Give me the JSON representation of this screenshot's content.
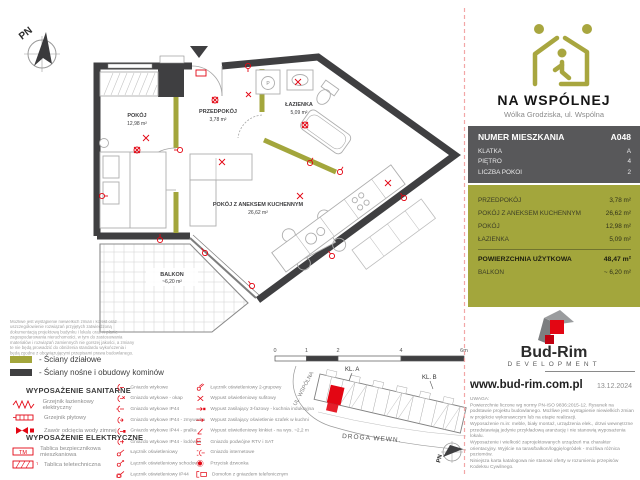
{
  "compass": {
    "label": "PN"
  },
  "floor_plan": {
    "rooms": [
      {
        "name": "POKÓJ",
        "area": "12,98 m²"
      },
      {
        "name": "PRZEDPOKÓJ",
        "area": "3,78 m²"
      },
      {
        "name": "ŁAZIENKA",
        "area": "5,09 m²"
      },
      {
        "name": "POKÓJ Z ANEKSEM KUCHENNYM",
        "area": "26,62 m²"
      },
      {
        "name": "BALKON",
        "area": "~6,20 m²"
      }
    ],
    "washer_label": "P"
  },
  "disclaimer_small": "Możliwe jest wystąpienie niewielkich zmian i korekt oraz uszczegółowienie rozwiązań przyjętych zatwierdzoną dokumentacją projektową budynku i lokalu oraz w planie zagospodarowania nieruchomości, w tym do zastosowania materiałów i rozwiązań zamiennych nie gorszej jakości, a zmiany te nie będą prowadzić do obniżenia standardu wykończenia i będą zgodne z obowiązującymi przepisami prawa budowlanego.",
  "wall_legend": [
    {
      "label": "- Ściany działowe",
      "color": "#a3a63c"
    },
    {
      "label": "- Ściany nośne i obudowy kominów",
      "color": "#3f3f41"
    }
  ],
  "sanitary": {
    "title": "WYPOSAŻENIE SANITARNE",
    "items": [
      "Grzejnik łazienkowy elektryczny",
      "Grzejnik płytowy",
      "Zawór odcięcia wody zimnej"
    ]
  },
  "electrical": {
    "title": "WYPOSAŻENIE ELEKTRYCZNE",
    "items": [
      {
        "tag": "TM",
        "label": "Tablica bezpiecznikowa mieszkaniowa"
      },
      {
        "tag": "TT",
        "label": "Tablica teletechniczna"
      }
    ]
  },
  "symbol_legend": {
    "col1": [
      "Gniazdo wtykowe",
      "Gniazdo wtykowe - okap",
      "Gniazdo wtykowe IP44",
      "Gniazdo wtykowe IP44 - zmywarka",
      "Gniazdo wtykowe IP44 - pralka",
      "Gniazdo wtykowe IP44 - lodówka",
      "Łącznik oświetleniowy",
      "Łącznik oświetleniowy schodowy",
      "Łącznik oświetleniowy IP44"
    ],
    "col2": [
      "Łącznik oświetleniowy 2-grupowy",
      "Wypust oświetleniowy sufitowy",
      "Wypust zasilający 3-fazowy - kuchnia indukcyjna",
      "Wypust zasilający oświetlenie szafek w kuchni",
      "Wypust oświetleniowy kinkiet - na wys. ~2,2 m",
      "Gniazdo podwójne RTV i SAT",
      "Gniazdo internetowe",
      "Przycisk dzwonka",
      "Domofon z gniazdem telefonicznym"
    ]
  },
  "scale_bar": {
    "ticks": [
      "0",
      "1",
      "2",
      "4",
      "6m"
    ]
  },
  "site_plan": {
    "stair_a": "KL. A",
    "stair_b": "KL. B",
    "road": "DROGA WEWN.",
    "street": "UL. WSPÓLNA",
    "north": "PN"
  },
  "branding": {
    "estate": "NA WSPÓLNEJ",
    "location": "Wólka Grodziska, ul. Wspólna",
    "developer": "Bud-Rim",
    "developer_sub": "DEVELOPMENT",
    "website": "www.bud-rim.com.pl",
    "date": "13.12.2024"
  },
  "summary": {
    "header_label": "NUMER  MIESZKANIA",
    "header_value": "A048",
    "rows": [
      {
        "label": "KLATKA",
        "value": "A"
      },
      {
        "label": "PIĘTRO",
        "value": "4"
      },
      {
        "label": "LICZBA POKOI",
        "value": "2"
      }
    ],
    "areas": [
      {
        "label": "PRZEDPOKÓJ",
        "value": "3,78 m²"
      },
      {
        "label": "POKÓJ Z ANEKSEM KUCHENNYM",
        "value": "26,62 m²"
      },
      {
        "label": "POKÓJ",
        "value": "12,98 m²"
      },
      {
        "label": "ŁAZIENKA",
        "value": "5,09 m²"
      }
    ],
    "total": {
      "label": "POWIERZCHNIA UŻYTKOWA",
      "value": "48,47 m²"
    },
    "balcony": {
      "label": "BALKON",
      "value": "~ 6,20 m²"
    }
  },
  "notes": {
    "text": "UWAGA:\nPowierzchnie liczone wg normy PN-ISO 9836:2015-12. Rysunek na podstawie projektu budowlanego. Możliwe jest wystąpienie niewielkich zmian w projekcie wykonawczym lub na etapie realizacji.\nWyposażenie m.in: meble, biały montaż, urządzenia elek., drzwi wewnętrzne przedstawiają jedynie przykładową aranżację i nie stanowią wyposażenia lokalu.\nWyposażenie i wielkość zaprojektowanych urządzeń ma charakter orientacyjny. Wyjście na taras/balkon/loggię/ogródek - możliwa różnica poziomów.\nNiniejsza karta katalogowa nie stanowi oferty w rozumieniu przepisów Kodeksu Cywilnego."
  }
}
